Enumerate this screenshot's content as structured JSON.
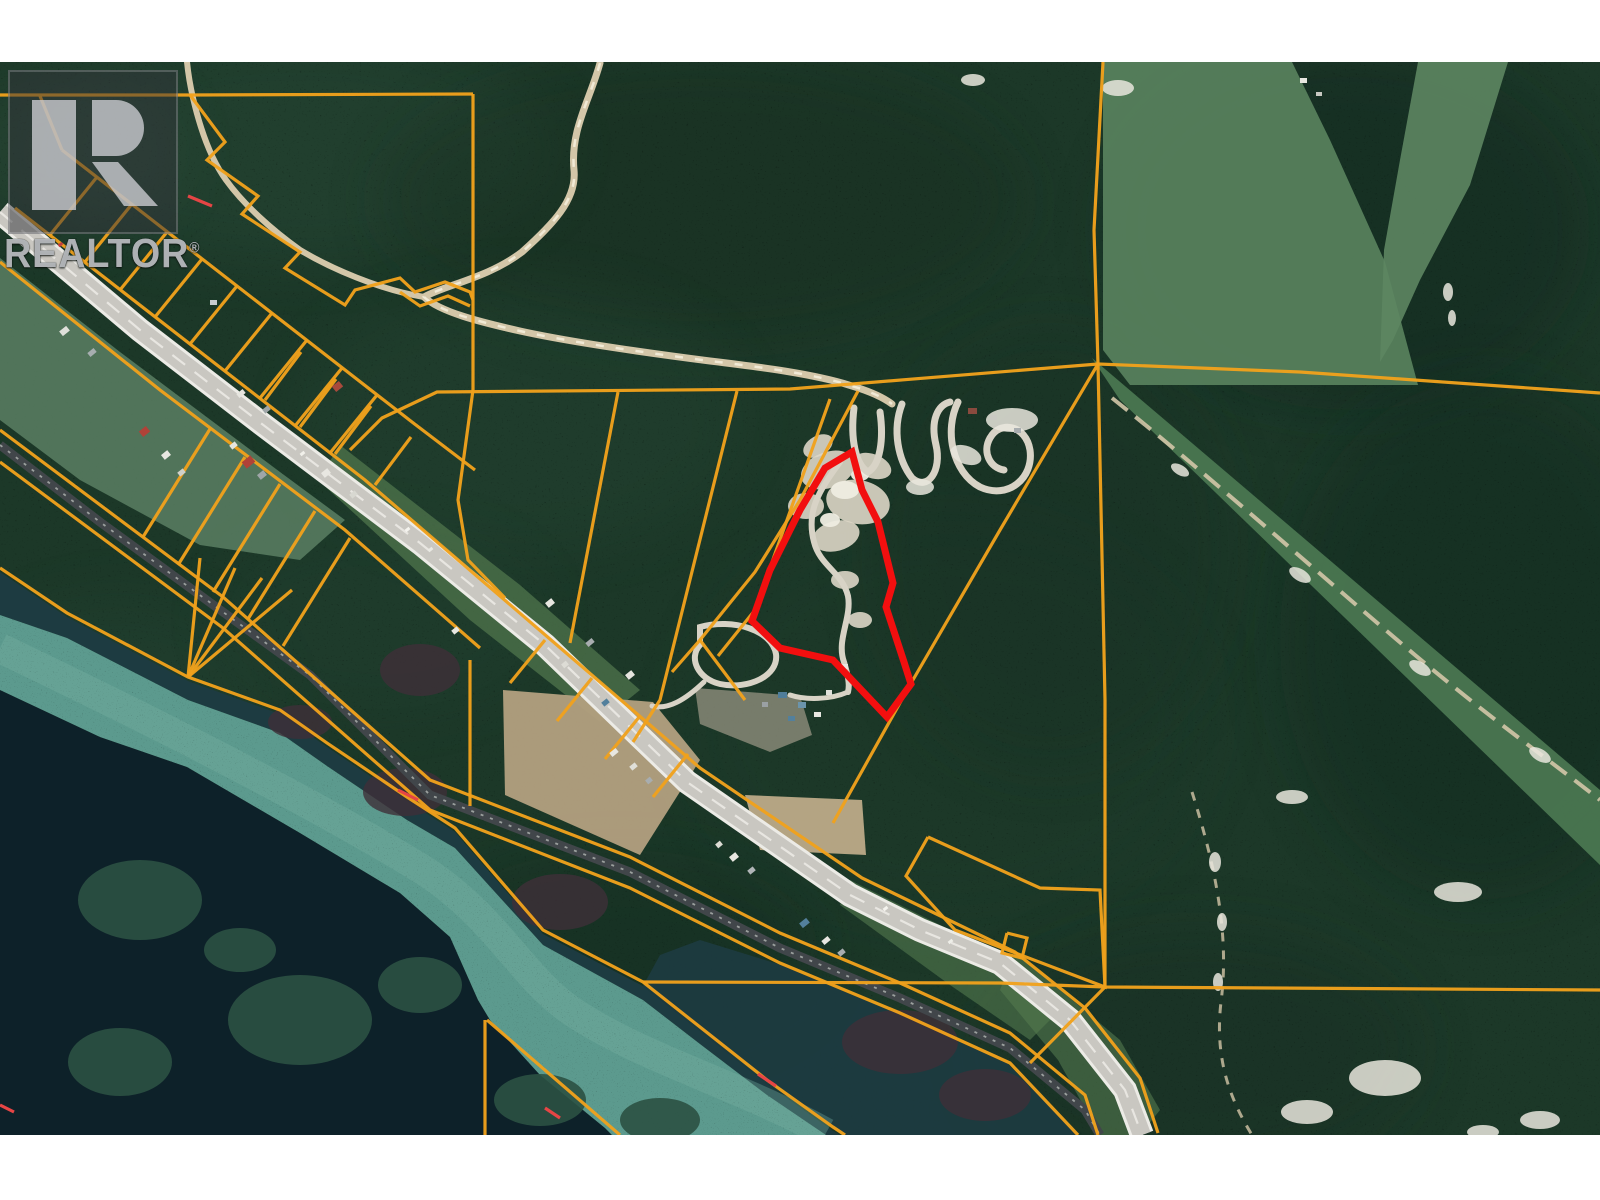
{
  "watermark": {
    "brand": "REALTOR",
    "reg": "®"
  },
  "map": {
    "kind": "satellite-parcel-map",
    "colors": {
      "forest": "#1c3828",
      "forest_light": "#33583e",
      "forest_dark": "#0f231a",
      "meadow": "#567f5c",
      "meadow2": "#5d8662",
      "corridor": "#4c7a53",
      "clearing": "#5b7f63",
      "grass": "#53794f",
      "field": "#b3a07f",
      "dirt": "#c5b08d",
      "dirt_gray": "#8f8d7c",
      "water_dark_sw": "#0d2129",
      "water_dark_ne": "#1d3b41",
      "channel": "#5c9a8e",
      "channel_light": "#79b2a3",
      "island": "#2b5142",
      "marsh": "#3f3038",
      "road_casing": "#ecebe6",
      "road_surface": "#c9c7c1",
      "road_center": "#e8e6e1",
      "rail": "#41464a",
      "rail_tie": "#9ba09e",
      "track": "#d3c6a8",
      "track_core": "#f1ead6",
      "switchback": "#d8d3c6",
      "parcel": "#f0a11c",
      "parcel_accent": "#e64545",
      "subject": "#f20f0f",
      "sand": "#ddd6c6",
      "sand_bright": "#efede2",
      "white": "#e9e6dd"
    },
    "blotches": [
      [
        300,
        150,
        260,
        110,
        "#2f5340",
        0.28
      ],
      [
        700,
        200,
        320,
        140,
        "#142a1f",
        0.32
      ],
      [
        1350,
        230,
        240,
        180,
        "#0e241b",
        0.35
      ],
      [
        1480,
        640,
        200,
        260,
        "#0f261e",
        0.35
      ],
      [
        950,
        720,
        260,
        200,
        "#1a3a2c",
        0.28
      ],
      [
        520,
        420,
        220,
        130,
        "#2b4d3a",
        0.22
      ],
      [
        120,
        700,
        150,
        100,
        "#2c4d3e",
        0.22
      ],
      [
        1200,
        1050,
        220,
        120,
        "#132b21",
        0.3
      ],
      [
        620,
        950,
        200,
        100,
        "#10271e",
        0.28
      ],
      [
        380,
        620,
        160,
        90,
        "#27483a",
        0.2
      ],
      [
        60,
        150,
        120,
        80,
        "#3a5a47",
        0.25
      ],
      [
        1050,
        550,
        180,
        220,
        "#152f24",
        0.3
      ]
    ],
    "terrain": {
      "meadows": [
        {
          "pts": "1103,62 1292,62 1330,140 1385,262 1418,385 1130,385 1103,350",
          "fill": "meadow",
          "op": 0.95
        },
        {
          "pts": "1418,62 1508,62 1470,185 1420,280 1393,340 1380,362 1384,250 1400,160",
          "fill": "meadow2",
          "op": 0.9
        }
      ],
      "corridor": "1092,358 1600,790 1600,865 1120,400",
      "clearings": [
        {
          "pts": "0,258 120,352 280,472 345,520 300,560 200,545 80,480 0,420",
          "fill": "clearing",
          "op": 0.85
        },
        {
          "pts": "340,445 520,585 640,690 600,722 470,620 318,480",
          "fill": "grass",
          "op": 0.7
        },
        {
          "pts": "850,880 1000,955 1060,1010 1030,1040 950,985 840,905",
          "fill": "grass",
          "op": 0.6
        },
        {
          "pts": "1015,952 1120,1040 1160,1110 1140,1135 1100,1135 1058,1060 1000,990",
          "fill": "grass",
          "op": 0.6
        }
      ],
      "fields": [
        {
          "pts": "503,690 653,702 700,760 640,855 505,795",
          "fill": "field",
          "op": 0.95
        },
        {
          "pts": "745,795 862,800 866,855 760,850",
          "fill": "dirt",
          "op": 0.9
        },
        {
          "pts": "695,688 800,696 812,735 770,752 700,724",
          "fill": "dirt_gray",
          "op": 0.8
        }
      ],
      "sand": [
        [
          828,
          470,
          28,
          18,
          -20
        ],
        [
          858,
          502,
          32,
          22,
          10
        ],
        [
          836,
          536,
          24,
          15,
          -15
        ],
        [
          806,
          506,
          18,
          13,
          0
        ],
        [
          872,
          466,
          20,
          12,
          20
        ],
        [
          818,
          446,
          16,
          10,
          -30
        ],
        [
          845,
          580,
          14,
          9,
          0
        ],
        [
          860,
          620,
          12,
          8,
          0
        ]
      ],
      "sand_bright": [
        [
          845,
          490,
          14,
          9,
          0
        ],
        [
          830,
          520,
          10,
          7,
          0
        ],
        [
          860,
          475,
          9,
          6,
          0
        ]
      ],
      "white_patches": [
        [
          1012,
          420,
          26,
          12,
          0
        ],
        [
          966,
          455,
          16,
          9,
          20
        ],
        [
          920,
          487,
          14,
          8,
          0
        ],
        [
          973,
          80,
          12,
          6,
          0
        ],
        [
          1118,
          88,
          16,
          8,
          0
        ],
        [
          1292,
          797,
          16,
          7,
          0
        ],
        [
          1458,
          892,
          24,
          10,
          0
        ],
        [
          1385,
          1078,
          36,
          18,
          0
        ],
        [
          1307,
          1112,
          26,
          12,
          0
        ],
        [
          1540,
          1120,
          20,
          9,
          0
        ],
        [
          1483,
          1132,
          16,
          7,
          0
        ],
        [
          1215,
          862,
          6,
          10,
          0
        ],
        [
          1222,
          922,
          5,
          9,
          0
        ],
        [
          1218,
          982,
          5,
          9,
          0
        ],
        [
          1448,
          292,
          5,
          9,
          0
        ],
        [
          1452,
          318,
          4,
          8,
          0
        ],
        [
          1180,
          470,
          10,
          5,
          30
        ],
        [
          1300,
          575,
          12,
          6,
          30
        ],
        [
          1420,
          668,
          12,
          6,
          30
        ],
        [
          1540,
          755,
          12,
          6,
          30
        ]
      ]
    },
    "water": {
      "dark_sw": "0,690 100,737 187,767 300,833 400,893 450,937 478,1000 490,1020 540,1075 605,1128 612,1135 0,1135",
      "channel": "0,615 67,638 188,700 280,733 327,766 407,820 455,848 543,945 643,1000 700,1044 767,1095 826,1135 612,1135 605,1128 540,1075 490,1020 478,1000 450,937 400,893 300,833 187,767 100,737 0,690",
      "dark_ne": "0,572 67,617 188,681 280,714 327,747 407,801 455,832 543,934 643,986 700,1031 767,1084 833,1131 840,1135 826,1135 767,1095 700,1044 643,1000 543,945 455,848 407,820 327,766 280,733 188,700 67,638 0,615",
      "marsh2": "643,986 700,1031 767,1084 845,1135 1078,1135 1008,1064 898,1014 778,964 700,940 660,955",
      "islands": [
        [
          140,
          900,
          62,
          40
        ],
        [
          300,
          1020,
          72,
          45
        ],
        [
          120,
          1062,
          52,
          34
        ],
        [
          420,
          985,
          42,
          28
        ],
        [
          240,
          950,
          36,
          22
        ],
        [
          540,
          1100,
          46,
          26
        ],
        [
          660,
          1120,
          40,
          22
        ]
      ],
      "marsh_patches": [
        [
          420,
          670,
          40,
          26
        ],
        [
          405,
          792,
          42,
          24
        ],
        [
          560,
          902,
          48,
          28
        ],
        [
          900,
          1042,
          58,
          32
        ],
        [
          300,
          722,
          32,
          17
        ],
        [
          985,
          1095,
          46,
          26
        ]
      ],
      "channel_center": "M 0,648 C 150,720 300,795 420,868 C 495,915 520,975 570,1010 C 640,1058 740,1085 826,1133"
    },
    "routes": {
      "highway": "0,212 140,330 262,424 420,543 545,645 687,782 850,895 920,930 1000,963 1070,1020 1125,1090 1142,1135",
      "railway": "0,445 100,522 223,612 310,675 430,795 630,872 780,948 900,998 1010,1048 1085,1110 1100,1135",
      "creek": "M 600,63 C 590,100 570,130 574,170 C 577,200 552,225 522,252 C 488,278 445,285 424,297 C 440,312 480,322 520,331 C 570,342 640,352 710,361 C 760,367 815,374 852,386 C 872,392 884,398 892,404",
      "creek_branch": "M 424,297 C 380,290 330,268 300,250 C 272,230 244,205 226,180 C 210,158 200,128 193,98 C 190,85 188,72 187,62",
      "switchbacks": [
        {
          "d": "M 854,408 C 850,440 856,465 868,472 C 880,465 884,440 880,412",
          "w": 7
        },
        {
          "d": "M 902,404 C 892,430 898,460 912,478 C 928,492 942,470 936,445 C 930,420 938,405 950,402",
          "w": 7
        },
        {
          "d": "M 958,402 C 944,430 952,472 980,487 C 1008,500 1034,478 1030,450 C 1026,425 1000,420 990,438 C 982,452 990,468 1004,470",
          "w": 7
        },
        {
          "d": "M 840,462 C 818,492 806,512 814,542 C 820,566 842,572 848,596 C 852,618 836,640 844,662 C 848,676 850,684 848,692",
          "w": 6
        },
        {
          "d": "M 848,692 C 830,700 805,700 790,695",
          "w": 5
        },
        {
          "d": "M 700,627 C 733,618 772,630 776,654 C 779,676 748,690 720,684 C 698,679 688,658 700,645 Z",
          "w": 6
        },
        {
          "d": "M 704,682 C 685,700 668,710 652,706",
          "w": 5
        }
      ],
      "corridor_track": "M 1112,398 C 1205,472 1320,575 1415,655 C 1495,722 1552,762 1600,800",
      "trail": "M 1192,792 C 1214,862 1230,932 1221,1002 C 1214,1062 1232,1102 1252,1135"
    },
    "parcel_lines": [
      "0,95 190,95 473,94",
      "473,94 473,390",
      "350,450 382,418 437,392 790,389 1098,364 1300,372 1600,393",
      "1103,62 1094,230 1098,364",
      "1098,364 1105,700 1105,987",
      "643,982 1000,983 1105,987 1600,990",
      "473,390 458,500 468,560 505,598",
      "618,392 570,643",
      "737,391 660,700 633,742",
      "830,399 755,610 718,656",
      "1098,364 1000,530 910,685 833,823",
      "858,391 800,500 755,572 700,640 672,672",
      "700,640 745,700",
      "15,208 365,480 700,768 862,878 1015,952 1085,1008 1140,1078 1158,1133",
      "0,262 160,390 345,530 480,648",
      "0,568 67,613 188,677 280,710 327,743 407,797 455,828 543,930 643,982 700,1027 767,1080 833,1127 845,1135",
      "0,430 223,597 430,780 630,857 780,933 900,983 1010,1033 1085,1095 1098,1135",
      "0,462 223,628 430,810 630,888 780,963 900,1013 1010,1063 1078,1135",
      "188,677 200,558",
      "188,677 235,568",
      "188,677 262,578",
      "188,677 292,590",
      "485,1020 485,1135",
      "487,1020 620,1135",
      "470,660 470,806",
      "190,95 225,142 207,160 258,196 242,214 300,252 285,268 345,305 355,290 400,278 415,292 445,282 470,292 473,300",
      "400,292 420,306 448,296 470,306",
      "62,150 412,422 475,470",
      "50,235 97,177",
      "85,262 132,204",
      "120,290 167,232",
      "155,317 202,259",
      "190,344 237,286",
      "225,371 272,313",
      "260,398 307,340",
      "295,426 342,368",
      "330,453 377,395",
      "265,400 301,352",
      "300,427 336,379",
      "335,454 371,406",
      "375,485 411,437",
      "210,429 143,537",
      "245,457 178,565",
      "280,484 213,592",
      "315,511 248,619",
      "350,538 283,646",
      "545,640 510,683",
      "592,678 557,721",
      "640,716 605,759",
      "688,754 653,797",
      "928,837 1040,888 1100,890 1105,987 955,930 906,876 928,837",
      "1007,933 1027,938 1022,958 1002,953 1007,933",
      "1105,987 1030,1063",
      "40,96 62,150"
    ],
    "accent_dashes": [
      "188,196 212,206",
      "398,790 418,800",
      "758,1074 776,1086",
      "545,1108 560,1118",
      "0,1105 14,1112"
    ],
    "buildings": [
      [
        60,
        328,
        9,
        6,
        "#dfe0da",
        -39
      ],
      [
        88,
        350,
        8,
        5,
        "#a7aeb0",
        -39
      ],
      [
        140,
        428,
        9,
        7,
        "#b04238",
        -39
      ],
      [
        162,
        452,
        8,
        6,
        "#e8e7e1",
        -39
      ],
      [
        178,
        470,
        7,
        5,
        "#cfd0c9",
        -39
      ],
      [
        237,
        391,
        8,
        5,
        "#e6e5df",
        -39
      ],
      [
        263,
        407,
        7,
        5,
        "#9fa6a8",
        -39
      ],
      [
        322,
        470,
        8,
        6,
        "#e8e7e1",
        -39
      ],
      [
        350,
        492,
        7,
        5,
        "#d8d8d1",
        -39
      ],
      [
        210,
        300,
        7,
        5,
        "#c9cdd0",
        0
      ],
      [
        243,
        458,
        11,
        8,
        "#b04238",
        -39
      ],
      [
        258,
        472,
        8,
        6,
        "#9fa6a8",
        -39
      ],
      [
        230,
        443,
        7,
        5,
        "#e6e5df",
        -39
      ],
      [
        333,
        383,
        9,
        7,
        "#a84a3c",
        -39
      ],
      [
        546,
        600,
        8,
        6,
        "#e8e7e1",
        -39
      ],
      [
        586,
        640,
        8,
        5,
        "#a8adaf",
        -39
      ],
      [
        626,
        672,
        8,
        6,
        "#e6e5df",
        -39
      ],
      [
        602,
        700,
        7,
        5,
        "#53809c",
        -39
      ],
      [
        562,
        662,
        6,
        5,
        "#dddcd5",
        -39
      ],
      [
        610,
        750,
        8,
        5,
        "#e8e7e1",
        -39
      ],
      [
        630,
        764,
        7,
        5,
        "#dfdfd8",
        -39
      ],
      [
        646,
        778,
        6,
        5,
        "#a8adaf",
        -39
      ],
      [
        730,
        854,
        8,
        6,
        "#e8e7e1",
        -39
      ],
      [
        748,
        868,
        7,
        5,
        "#b0b5b7",
        -39
      ],
      [
        716,
        842,
        6,
        5,
        "#dcdbd4",
        -39
      ],
      [
        800,
        920,
        9,
        6,
        "#53809c",
        -39
      ],
      [
        822,
        938,
        8,
        5,
        "#e8e7e1",
        -39
      ],
      [
        838,
        950,
        7,
        5,
        "#a8adaf",
        -39
      ],
      [
        778,
        692,
        9,
        6,
        "#4f7d9a",
        0
      ],
      [
        798,
        702,
        8,
        6,
        "#6b94ab",
        0
      ],
      [
        814,
        712,
        7,
        5,
        "#e8e7e1",
        0
      ],
      [
        762,
        702,
        6,
        5,
        "#9aa0a3",
        0
      ],
      [
        788,
        716,
        7,
        5,
        "#53809c",
        0
      ],
      [
        826,
        690,
        6,
        5,
        "#dfe0da",
        0
      ],
      [
        842,
        664,
        6,
        5,
        "#e8e7e1",
        0
      ],
      [
        968,
        408,
        9,
        6,
        "#8a4a3e",
        0
      ],
      [
        990,
        415,
        7,
        5,
        "#c9c9c2",
        0
      ],
      [
        1014,
        428,
        7,
        5,
        "#a8adaf",
        0
      ],
      [
        1300,
        78,
        7,
        5,
        "#e8e7e1",
        0
      ],
      [
        1316,
        92,
        6,
        4,
        "#c8c9c2",
        0
      ],
      [
        452,
        628,
        7,
        5,
        "#e8e7e1",
        -39
      ]
    ],
    "vehicles": [
      [
        405,
        528,
        5,
        3,
        "#f4f3ee"
      ],
      [
        428,
        548,
        5,
        3,
        "#e9e9e3"
      ],
      [
        883,
        907,
        5,
        3,
        "#f4f3ee"
      ],
      [
        58,
        243,
        5,
        3,
        "#c04040"
      ],
      [
        948,
        940,
        5,
        3,
        "#eeeee8"
      ],
      [
        300,
        452,
        5,
        3,
        "#f1f0ea"
      ]
    ],
    "subject_boundary": "852,452 862,490 878,522 893,583 886,607 904,662 911,684 887,717 833,660 780,648 752,621 770,570 800,510 825,468"
  }
}
